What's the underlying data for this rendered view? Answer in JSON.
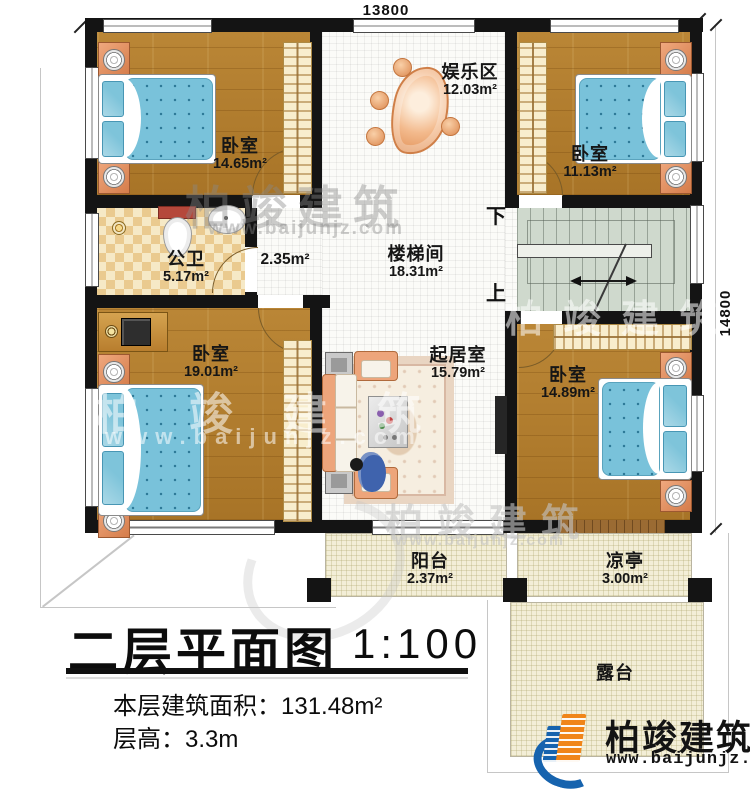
{
  "drawing": {
    "title": "二层平面图",
    "scale": "1:100",
    "floor_area_label": "本层建筑面积：",
    "floor_area_value": "131.48m²",
    "floor_height_label": "层高：",
    "floor_height_value": "3.3m"
  },
  "dimensions": {
    "width_mm": "13800",
    "height_mm": "14800"
  },
  "rooms": [
    {
      "name": "卧室",
      "area": "14.65m²"
    },
    {
      "name": "娱乐区",
      "area": "12.03m²"
    },
    {
      "name": "卧室",
      "area": "11.13m²"
    },
    {
      "name": "公卫",
      "area": "5.17m²"
    },
    {
      "name": "",
      "area": "2.35m²"
    },
    {
      "name": "楼梯间",
      "area": "18.31m²"
    },
    {
      "name": "卧室",
      "area": "19.01m²"
    },
    {
      "name": "起居室",
      "area": "15.79m²"
    },
    {
      "name": "卧室",
      "area": "14.89m²"
    },
    {
      "name": "阳台",
      "area": "2.37m²"
    },
    {
      "name": "凉亭",
      "area": "3.00m²"
    },
    {
      "name": "露台",
      "area": ""
    }
  ],
  "stairs": {
    "down_label": "下",
    "up_label": "上"
  },
  "watermark": {
    "brand": "柏竣建筑",
    "url": "www.baijunjz.com"
  },
  "logo": {
    "brand": "柏竣建筑",
    "url": "www.baijunjz.com"
  },
  "colors": {
    "wall": "#141414",
    "wood_floor": "#b2802f",
    "mattress": "#79c2da",
    "nightstand": "#e0875f",
    "tile": "#eaca8f",
    "stairs": "#cfd9cd",
    "balcony": "#f3eed7",
    "brand_blue": "#1663ae",
    "brand_orange": "#f08519"
  }
}
